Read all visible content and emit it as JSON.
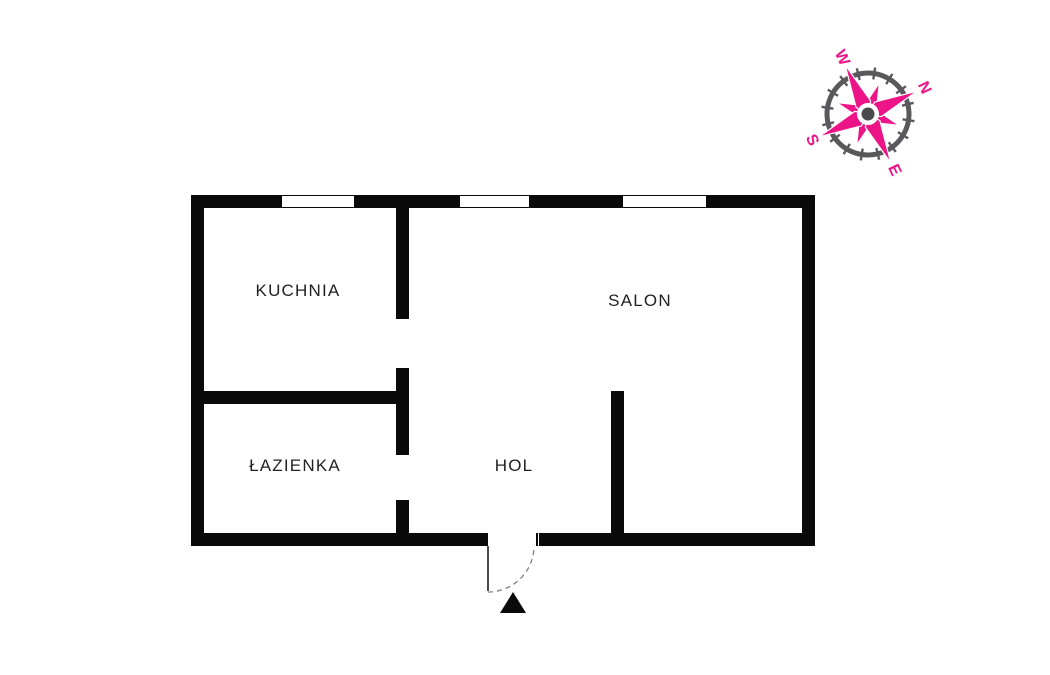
{
  "rooms": {
    "kuchnia": "KUCHNIA",
    "salon": "SALON",
    "lazienka": "ŁAZIENKA",
    "hol": "HOL"
  },
  "compass": {
    "n": "N",
    "e": "E",
    "s": "S",
    "w": "W",
    "rotation_deg": 65,
    "star_color": "#EC1486",
    "ring_color": "#59595B",
    "hub_color": "#4A4A4C"
  },
  "entrance": {
    "marker": "arrow-triangle",
    "door_swing": "dashed-quarter-arc"
  },
  "colors": {
    "background": "#FFFFFF",
    "wall": "#0A0A0A",
    "label_text": "#231F20",
    "door_line": "#808080"
  }
}
